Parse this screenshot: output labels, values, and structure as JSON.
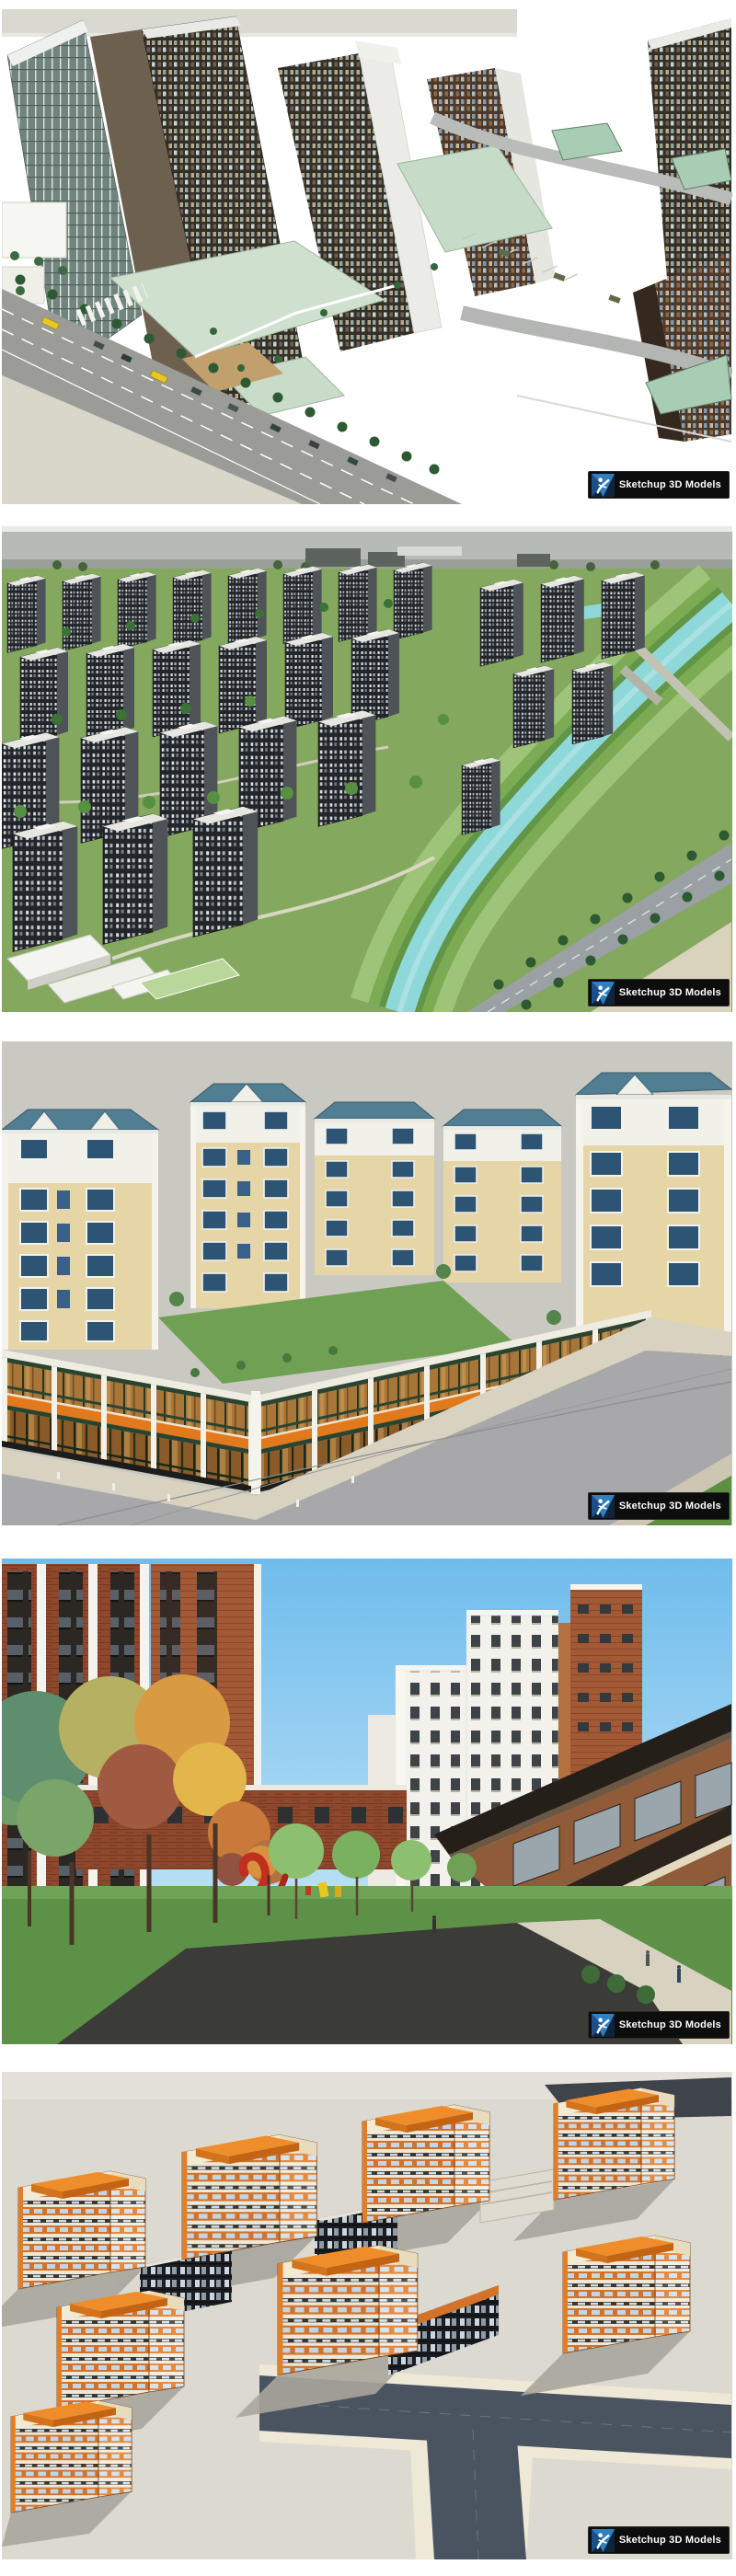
{
  "page": {
    "background": "#ffffff"
  },
  "watermark": {
    "label": "Sketchup 3D Models",
    "badge_bg": "#0d0d0d",
    "text_color": "#ffffff",
    "logo_blue_dark": "#1b4f8a",
    "logo_blue_light": "#2f7fc1",
    "logo_figure": "#ffffff"
  },
  "renders": [
    {
      "name": "aerial-commercial-highrise-towers",
      "palette": [
        "#ffffff",
        "#342e26",
        "#cfe0cf",
        "#9b9b97",
        "#e8c822"
      ]
    },
    {
      "name": "aerial-residential-district-river",
      "palette": [
        "#b7bbb5",
        "#22262a",
        "#83a85e",
        "#8fd8da"
      ]
    },
    {
      "name": "blue-roof-apartments-retail-podium",
      "palette": [
        "#c9c8c1",
        "#517e92",
        "#e5d5a7",
        "#e1791d",
        "#a8a8ab"
      ]
    },
    {
      "name": "street-view-brick-towers-autumn",
      "palette": [
        "#6fbcec",
        "#8e4a2f",
        "#5e9148",
        "#e2b64a",
        "#c22f1e"
      ]
    },
    {
      "name": "aerial-orange-office-blocks",
      "palette": [
        "#dcd9d0",
        "#ef8d2a",
        "#3b372f",
        "#4a5360"
      ]
    }
  ]
}
